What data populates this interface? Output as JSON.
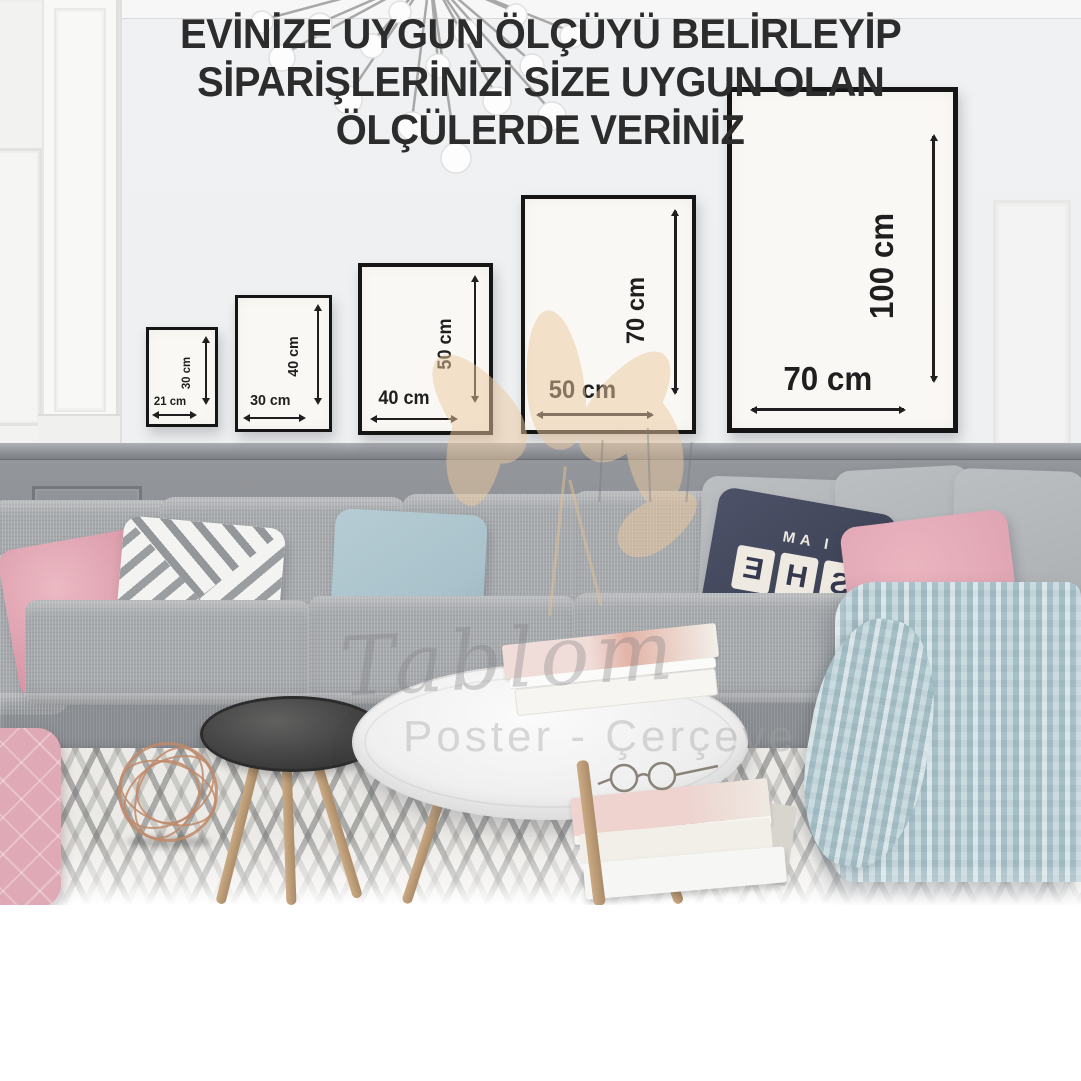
{
  "frames": [
    {
      "name": "frame-21x30",
      "width_label": "21 cm",
      "height_label": "30 cm"
    },
    {
      "name": "frame-30x40",
      "width_label": "30 cm",
      "height_label": "40 cm"
    },
    {
      "name": "frame-40x50",
      "width_label": "40 cm",
      "height_label": "50 cm"
    },
    {
      "name": "frame-50x70",
      "width_label": "50 cm",
      "height_label": "70 cm"
    },
    {
      "name": "frame-70x100",
      "width_label": "70 cm",
      "height_label": "100 cm"
    }
  ],
  "pillow": {
    "line1": "I AM",
    "tiles": [
      "S",
      "H",
      "E"
    ],
    "line3": "LOCKED"
  },
  "watermark": {
    "script": "Tablom",
    "subline": "Poster - Çerçeve"
  },
  "caption": {
    "line1": "EVİNİZE UYGUN ÖLÇÜYÜ BELİRLEYİP",
    "line2": "SİPARİŞLERİNİZİ SİZE UYGUN OLAN",
    "line3": "ÖLÇÜLERDE VERİNİZ"
  },
  "colors": {
    "wall": "#f0f1f2",
    "wainscot": "#888b8f",
    "frame_border": "#151515",
    "poster": "#faf8f4",
    "arrow": "#1f1f1f",
    "sofa": "#a6a9ac",
    "pink": "#e0a5b3",
    "blue": "#a9c2cb",
    "navy": "#3e4357",
    "blanket": "#bdd2d8",
    "rug_bg": "#eceae6",
    "copper": "#c08a6a",
    "flower": "#ecc9a0",
    "caption_text": "#2c2c2c",
    "caption_bg": "#ffffff"
  }
}
